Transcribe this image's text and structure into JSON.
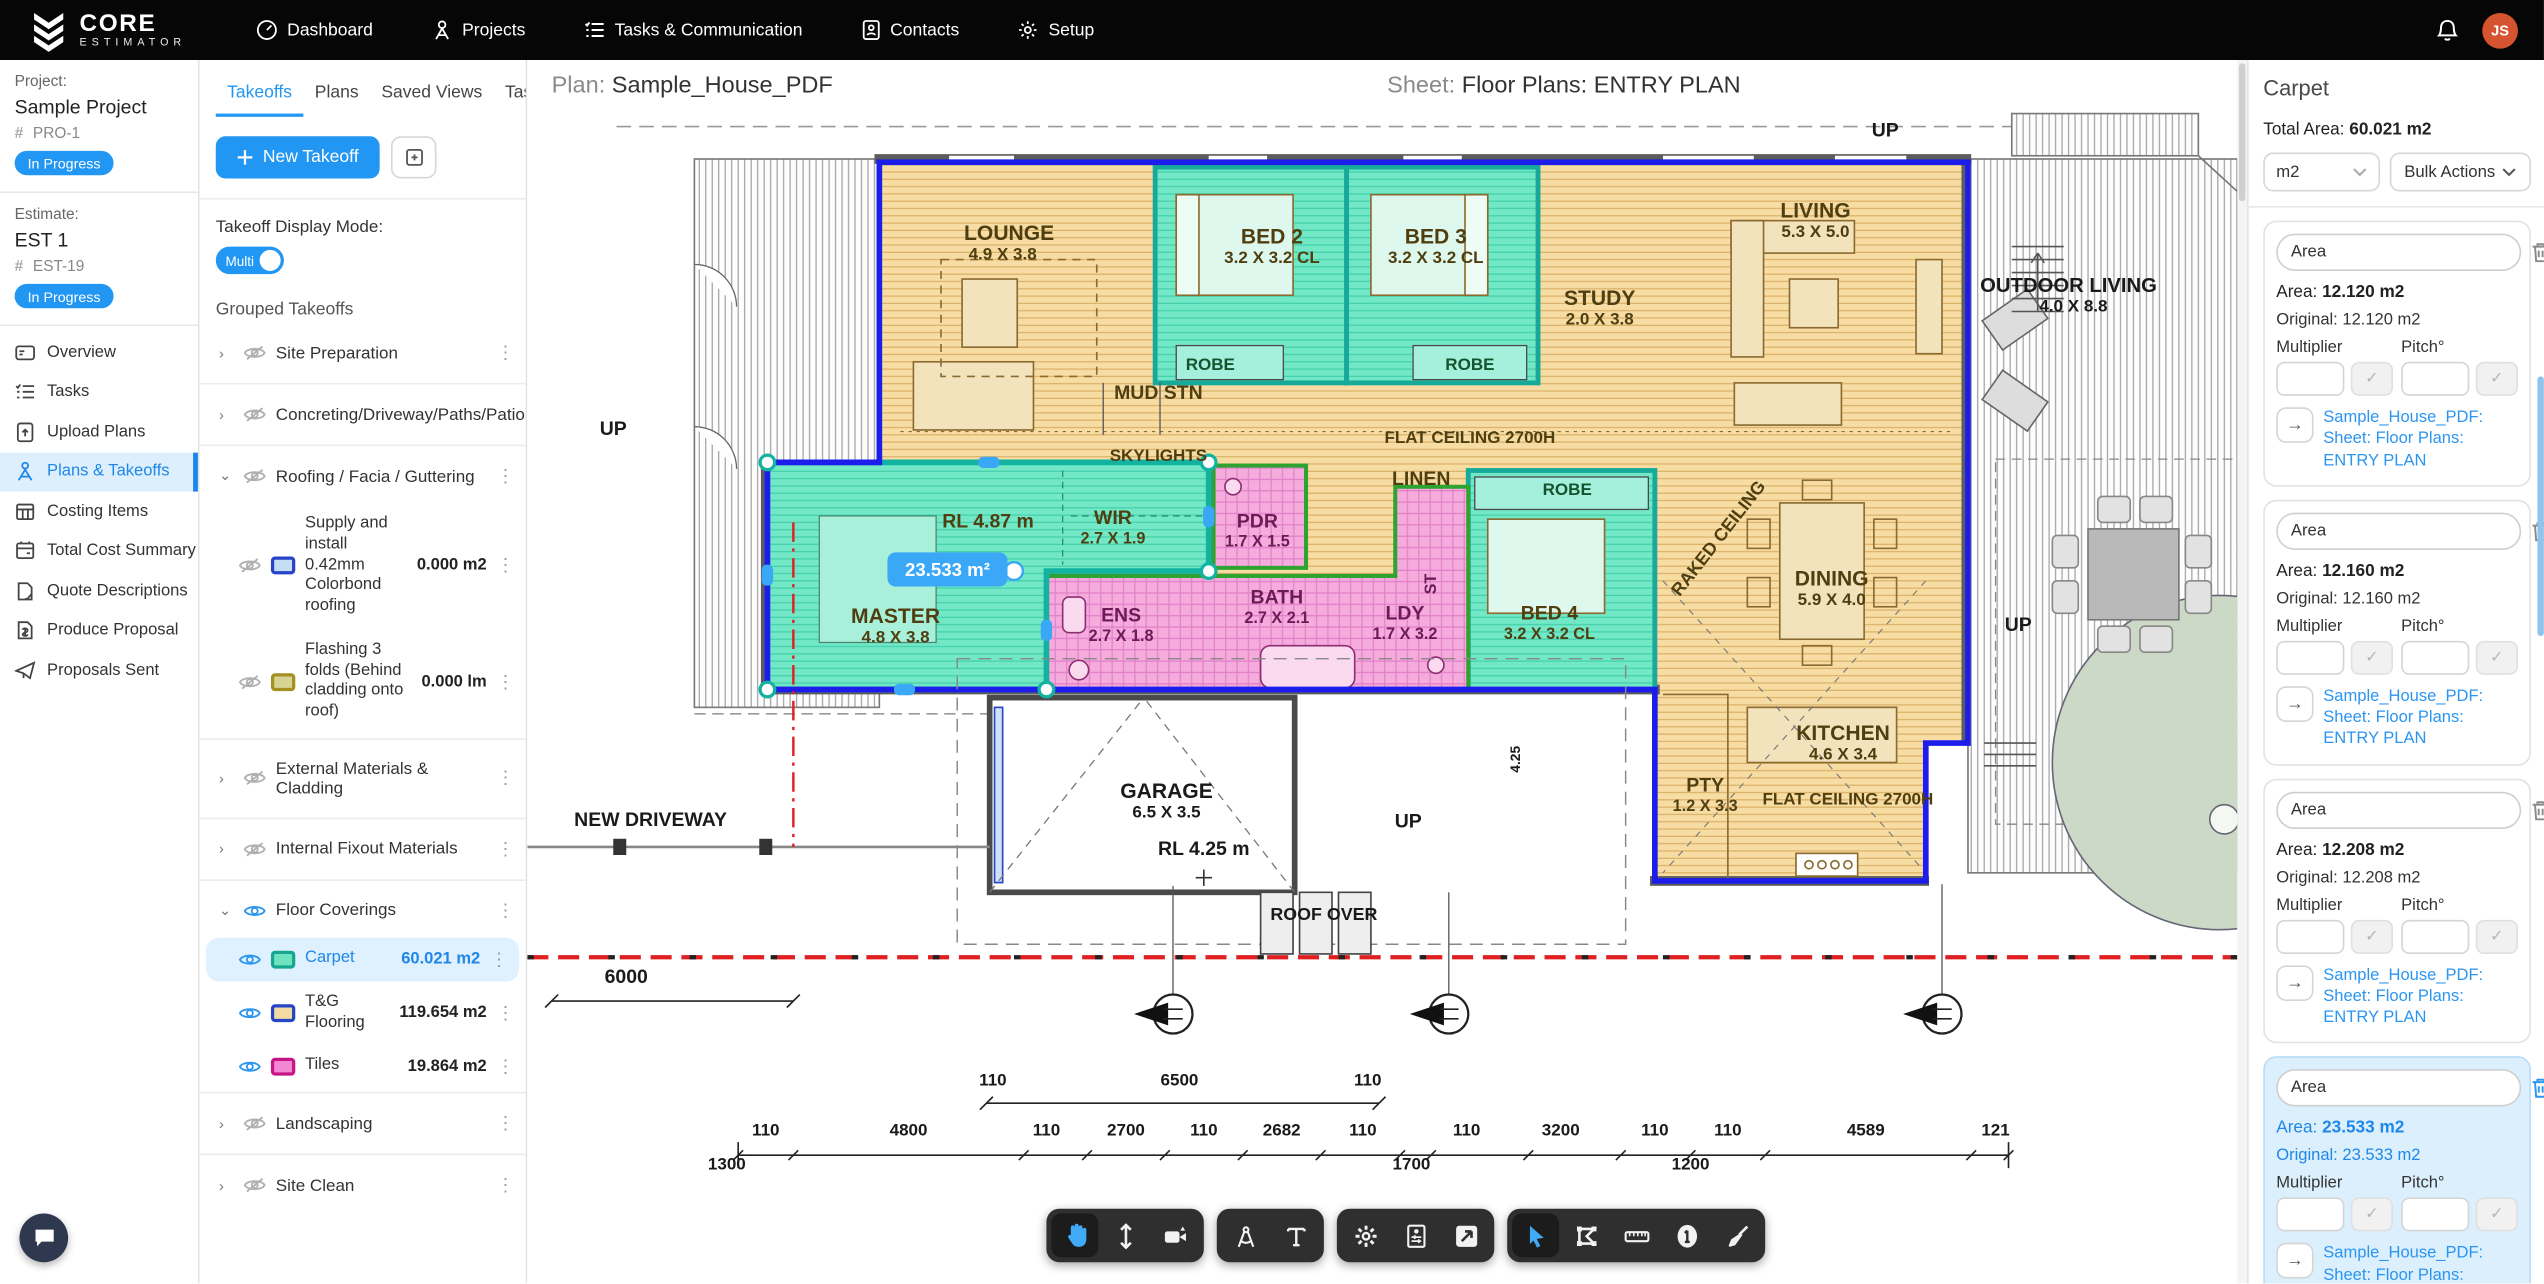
{
  "topbar": {
    "brand_line1": "CORE",
    "brand_line2": "ESTIMATOR",
    "nav": [
      {
        "label": "Dashboard",
        "icon": "dashboard-icon"
      },
      {
        "label": "Projects",
        "icon": "projects-icon"
      },
      {
        "label": "Tasks & Communication",
        "icon": "tasks-icon"
      },
      {
        "label": "Contacts",
        "icon": "contacts-icon"
      },
      {
        "label": "Setup",
        "icon": "setup-icon"
      }
    ],
    "avatar_initials": "JS",
    "avatar_color": "#d5532f"
  },
  "sidebar": {
    "project_label": "Project:",
    "project_name": "Sample Project",
    "project_code": "PRO-1",
    "project_status": "In Progress",
    "estimate_label": "Estimate:",
    "estimate_name": "EST 1",
    "estimate_code": "EST-19",
    "estimate_status": "In Progress",
    "menu": [
      {
        "label": "Overview",
        "active": false
      },
      {
        "label": "Tasks",
        "active": false
      },
      {
        "label": "Upload Plans",
        "active": false
      },
      {
        "label": "Plans & Takeoffs",
        "active": true
      },
      {
        "label": "Costing Items",
        "active": false
      },
      {
        "label": "Total Cost Summary",
        "active": false
      },
      {
        "label": "Quote Descriptions",
        "active": false
      },
      {
        "label": "Produce Proposal",
        "active": false
      },
      {
        "label": "Proposals Sent",
        "active": false
      }
    ]
  },
  "takeoff_panel": {
    "tabs": [
      "Takeoffs",
      "Plans",
      "Saved Views",
      "Tasks"
    ],
    "active_tab": "Takeoffs",
    "new_takeoff_label": "New Takeoff",
    "display_mode_label": "Takeoff Display Mode:",
    "display_mode_value": "Multi",
    "grouped_label": "Grouped Takeoffs",
    "groups": [
      {
        "name": "Site Preparation",
        "expanded": false,
        "visible": false,
        "items": []
      },
      {
        "name": "Concreting/Driveway/Paths/Patios",
        "expanded": false,
        "visible": false,
        "items": []
      },
      {
        "name": "Roofing / Facia / Guttering",
        "expanded": true,
        "visible": false,
        "items": [
          {
            "name": "Supply and install 0.42mm Colorbond roofing",
            "qty": "0.000 m2",
            "swatch": "#c3ddf3",
            "swatch_border": "#2743c7",
            "visible": false,
            "selected": false
          },
          {
            "name": "Flashing 3 folds (Behind cladding onto roof)",
            "qty": "0.000 lm",
            "swatch": "#d6d393",
            "swatch_border": "#a3901f",
            "visible": false,
            "selected": false
          }
        ]
      },
      {
        "name": "External Materials & Cladding",
        "expanded": false,
        "visible": false,
        "items": []
      },
      {
        "name": "Internal Fixout Materials",
        "expanded": false,
        "visible": false,
        "items": []
      },
      {
        "name": "Floor Coverings",
        "expanded": true,
        "visible": true,
        "items": [
          {
            "name": "Carpet",
            "qty": "60.021 m2",
            "swatch": "#6fe3c0",
            "swatch_border": "#16a68f",
            "visible": true,
            "selected": true
          },
          {
            "name": "T&G Flooring",
            "qty": "119.654 m2",
            "swatch": "#f3d9a2",
            "swatch_border": "#2743c7",
            "visible": true,
            "selected": false
          },
          {
            "name": "Tiles",
            "qty": "19.864 m2",
            "swatch": "#f287d3",
            "swatch_border": "#c71585",
            "visible": true,
            "selected": false
          }
        ]
      },
      {
        "name": "Landscaping",
        "expanded": false,
        "visible": false,
        "items": []
      },
      {
        "name": "Site Clean",
        "expanded": false,
        "visible": false,
        "items": []
      }
    ]
  },
  "canvas": {
    "plan_label": "Plan:",
    "plan_value": "Sample_House_PDF",
    "sheet_label": "Sheet:",
    "sheet_value": "Floor Plans: ENTRY PLAN",
    "measurement_tag": "23.533 m²",
    "colors": {
      "carpet_fill": "#70e7c5",
      "carpet_border": "#17a99a",
      "tg_fill": "#f7dca4",
      "tiles_fill": "#f6abdd",
      "tiles_border": "#2fa32f",
      "outline_blue": "#1d1deb",
      "setback_red": "#e02020"
    },
    "plan_labels": [
      {
        "t": "UP",
        "x": 837,
        "y": 16,
        "fs": 12,
        "c": "#1a1a1a"
      },
      {
        "t": "LOUNGE",
        "x": 297,
        "y": 80,
        "fs": 13
      },
      {
        "t": "4.9 X 3.8",
        "x": 293,
        "y": 92,
        "fs": 10.5
      },
      {
        "t": "BED 2",
        "x": 459,
        "y": 82,
        "fs": 13
      },
      {
        "t": "3.2 X 3.2 CL",
        "x": 459,
        "y": 94,
        "fs": 10.5
      },
      {
        "t": "BED 3",
        "x": 560,
        "y": 82,
        "fs": 13
      },
      {
        "t": "3.2 X 3.2 CL",
        "x": 560,
        "y": 94,
        "fs": 10.5
      },
      {
        "t": "STUDY",
        "x": 661,
        "y": 120,
        "fs": 13
      },
      {
        "t": "2.0 X 3.8",
        "x": 661,
        "y": 132,
        "fs": 10.5
      },
      {
        "t": "LIVING",
        "x": 794,
        "y": 66,
        "fs": 13
      },
      {
        "t": "5.3 X 5.0",
        "x": 794,
        "y": 78,
        "fs": 10.5
      },
      {
        "t": "OUTDOOR LIVING",
        "x": 950,
        "y": 112,
        "fs": 12.5,
        "c": "#1a1a1a"
      },
      {
        "t": "4.0 X 8.8",
        "x": 953,
        "y": 124,
        "fs": 10.5,
        "c": "#1a1a1a"
      },
      {
        "t": "ROBE",
        "x": 421,
        "y": 160,
        "fs": 10.5,
        "c": "#14532d"
      },
      {
        "t": "ROBE",
        "x": 581,
        "y": 160,
        "fs": 10.5,
        "c": "#14532d"
      },
      {
        "t": "MUD STN",
        "x": 389,
        "y": 178,
        "fs": 12
      },
      {
        "t": "FLAT CEILING 2700H",
        "x": 581,
        "y": 205,
        "fs": 10.5
      },
      {
        "t": "SKYLIGHTS",
        "x": 389,
        "y": 216,
        "fs": 10.5
      },
      {
        "t": "LINEN",
        "x": 551,
        "y": 231,
        "fs": 12
      },
      {
        "t": "ROBE",
        "x": 641,
        "y": 237,
        "fs": 10.5,
        "c": "#14532d"
      },
      {
        "t": "RAKED CEILING",
        "x": 737,
        "y": 266,
        "fs": 11,
        "r": -52
      },
      {
        "t": "RL 4.87 m",
        "x": 284,
        "y": 257,
        "fs": 12
      },
      {
        "t": "WIR",
        "x": 361,
        "y": 255,
        "fs": 12
      },
      {
        "t": "2.7 X 1.9",
        "x": 361,
        "y": 267,
        "fs": 10
      },
      {
        "t": "PDR",
        "x": 450,
        "y": 257,
        "fs": 12,
        "c": "#6d1b57"
      },
      {
        "t": "1.7 X 1.5",
        "x": 450,
        "y": 269,
        "fs": 10,
        "c": "#6d1b57"
      },
      {
        "t": "MASTER",
        "x": 227,
        "y": 316,
        "fs": 13
      },
      {
        "t": "4.8 X 3.8",
        "x": 227,
        "y": 328,
        "fs": 10.5
      },
      {
        "t": "ENS",
        "x": 366,
        "y": 315,
        "fs": 12,
        "c": "#6d1b57"
      },
      {
        "t": "2.7 X 1.8",
        "x": 366,
        "y": 327,
        "fs": 10,
        "c": "#6d1b57"
      },
      {
        "t": "BATH",
        "x": 462,
        "y": 304,
        "fs": 12,
        "c": "#6d1b57"
      },
      {
        "t": "2.7 X 2.1",
        "x": 462,
        "y": 316,
        "fs": 10,
        "c": "#6d1b57"
      },
      {
        "t": "LDY",
        "x": 541,
        "y": 314,
        "fs": 12,
        "c": "#6d1b57"
      },
      {
        "t": "1.7 X 3.2",
        "x": 541,
        "y": 326,
        "fs": 10,
        "c": "#6d1b57"
      },
      {
        "t": "ST",
        "x": 560,
        "y": 292,
        "fs": 10,
        "c": "#6d1b57",
        "r": -90
      },
      {
        "t": "BED 4",
        "x": 630,
        "y": 314,
        "fs": 12
      },
      {
        "t": "3.2 X 3.2 CL",
        "x": 630,
        "y": 326,
        "fs": 10
      },
      {
        "t": "DINING",
        "x": 804,
        "y": 293,
        "fs": 13
      },
      {
        "t": "5.9 X 4.0",
        "x": 804,
        "y": 305,
        "fs": 10.5
      },
      {
        "t": "KITCHEN",
        "x": 811,
        "y": 388,
        "fs": 13
      },
      {
        "t": "4.6 X 3.4",
        "x": 811,
        "y": 400,
        "fs": 10.5
      },
      {
        "t": "PTY",
        "x": 726,
        "y": 420,
        "fs": 12
      },
      {
        "t": "1.2 X 3.3",
        "x": 726,
        "y": 432,
        "fs": 10
      },
      {
        "t": "FLAT CEILING 2700H",
        "x": 814,
        "y": 428,
        "fs": 10.5
      },
      {
        "t": "GARAGE",
        "x": 394,
        "y": 424,
        "fs": 13,
        "c": "#1a1a1a"
      },
      {
        "t": "6.5 X 3.5",
        "x": 394,
        "y": 436,
        "fs": 10.5,
        "c": "#1a1a1a"
      },
      {
        "t": "RL 4.25 m",
        "x": 417,
        "y": 459,
        "fs": 12,
        "c": "#1a1a1a"
      },
      {
        "t": "NEW DRIVEWAY",
        "x": 76,
        "y": 441,
        "fs": 12,
        "c": "#1a1a1a"
      },
      {
        "t": "ROOF OVER",
        "x": 491,
        "y": 499,
        "fs": 11,
        "c": "#1a1a1a"
      },
      {
        "t": "UP",
        "x": 543,
        "y": 442,
        "fs": 12,
        "c": "#1a1a1a"
      },
      {
        "t": "UP",
        "x": 919,
        "y": 321,
        "fs": 12,
        "c": "#1a1a1a"
      },
      {
        "t": "UP",
        "x": 53,
        "y": 200,
        "fs": 12,
        "c": "#1a1a1a"
      },
      {
        "t": "4.25",
        "x": 612,
        "y": 400,
        "fs": 8.5,
        "c": "#1a1a1a",
        "r": -90
      },
      {
        "t": "6000",
        "x": 61,
        "y": 538,
        "fs": 12,
        "c": "#1a1a1a"
      },
      {
        "t": "110",
        "x": 287,
        "y": 601,
        "fs": 10.5,
        "c": "#1a1a1a"
      },
      {
        "t": "6500",
        "x": 402,
        "y": 601,
        "fs": 10.5,
        "c": "#1a1a1a"
      },
      {
        "t": "110",
        "x": 518,
        "y": 601,
        "fs": 10.5,
        "c": "#1a1a1a"
      },
      {
        "t": "110",
        "x": 147,
        "y": 632,
        "fs": 10.5,
        "c": "#1a1a1a"
      },
      {
        "t": "4800",
        "x": 235,
        "y": 632,
        "fs": 10.5,
        "c": "#1a1a1a"
      },
      {
        "t": "110",
        "x": 320,
        "y": 632,
        "fs": 10.5,
        "c": "#1a1a1a"
      },
      {
        "t": "2700",
        "x": 369,
        "y": 632,
        "fs": 10.5,
        "c": "#1a1a1a"
      },
      {
        "t": "110",
        "x": 417,
        "y": 632,
        "fs": 10.5,
        "c": "#1a1a1a"
      },
      {
        "t": "2682",
        "x": 465,
        "y": 632,
        "fs": 10.5,
        "c": "#1a1a1a"
      },
      {
        "t": "110",
        "x": 515,
        "y": 632,
        "fs": 10.5,
        "c": "#1a1a1a"
      },
      {
        "t": "110",
        "x": 579,
        "y": 632,
        "fs": 10.5,
        "c": "#1a1a1a"
      },
      {
        "t": "3200",
        "x": 637,
        "y": 632,
        "fs": 10.5,
        "c": "#1a1a1a"
      },
      {
        "t": "110",
        "x": 695,
        "y": 632,
        "fs": 10.5,
        "c": "#1a1a1a"
      },
      {
        "t": "110",
        "x": 740,
        "y": 632,
        "fs": 10.5,
        "c": "#1a1a1a"
      },
      {
        "t": "4589",
        "x": 825,
        "y": 632,
        "fs": 10.5,
        "c": "#1a1a1a"
      },
      {
        "t": "121",
        "x": 905,
        "y": 632,
        "fs": 10.5,
        "c": "#1a1a1a"
      },
      {
        "t": "1300",
        "x": 123,
        "y": 653,
        "fs": 10.5,
        "c": "#1a1a1a"
      },
      {
        "t": "1700",
        "x": 545,
        "y": 653,
        "fs": 10.5,
        "c": "#1a1a1a"
      },
      {
        "t": "1200",
        "x": 717,
        "y": 653,
        "fs": 10.5,
        "c": "#1a1a1a"
      }
    ]
  },
  "toolbar": {
    "groups": [
      [
        {
          "icon": "hand-tool-icon",
          "active": true
        },
        {
          "icon": "vertical-arrows-icon",
          "active": false
        },
        {
          "icon": "camera-icon",
          "active": false
        }
      ],
      [
        {
          "icon": "compass-tool-icon",
          "active": false
        },
        {
          "icon": "text-tool-icon",
          "active": false
        }
      ],
      [
        {
          "icon": "gear-icon",
          "active": false
        },
        {
          "icon": "layers-panel-icon",
          "active": false
        },
        {
          "icon": "expand-icon",
          "active": false
        }
      ],
      [
        {
          "icon": "cursor-tool-icon",
          "active": true
        },
        {
          "icon": "polygon-tool-icon",
          "active": false
        },
        {
          "icon": "ruler-icon",
          "active": false
        },
        {
          "icon": "count-one-icon",
          "active": false
        },
        {
          "icon": "broom-icon",
          "active": false
        }
      ]
    ]
  },
  "right_panel": {
    "title": "Carpet",
    "total_label": "Total Area:",
    "total_value": "60.021 m2",
    "unit_value": "m2",
    "bulk_actions_label": "Bulk Actions",
    "multiplier_label": "Multiplier",
    "pitch_label": "Pitch°",
    "cards": [
      {
        "name_value": "Area",
        "area_label": "Area:",
        "area_value": "12.120 m2",
        "original_label": "Original:",
        "original_value": "12.120 m2",
        "link": "Sample_House_PDF: Sheet: Floor Plans: ENTRY PLAN",
        "selected": false
      },
      {
        "name_value": "Area",
        "area_label": "Area:",
        "area_value": "12.160 m2",
        "original_label": "Original:",
        "original_value": "12.160 m2",
        "link": "Sample_House_PDF: Sheet: Floor Plans: ENTRY PLAN",
        "selected": false
      },
      {
        "name_value": "Area",
        "area_label": "Area:",
        "area_value": "12.208 m2",
        "original_label": "Original:",
        "original_value": "12.208 m2",
        "link": "Sample_House_PDF: Sheet: Floor Plans: ENTRY PLAN",
        "selected": false
      },
      {
        "name_value": "Area",
        "area_label": "Area:",
        "area_value": "23.533 m2",
        "original_label": "Original:",
        "original_value": "23.533 m2",
        "link": "Sample_House_PDF: Sheet: Floor Plans: ENTRY PLAN",
        "selected": true
      }
    ]
  }
}
